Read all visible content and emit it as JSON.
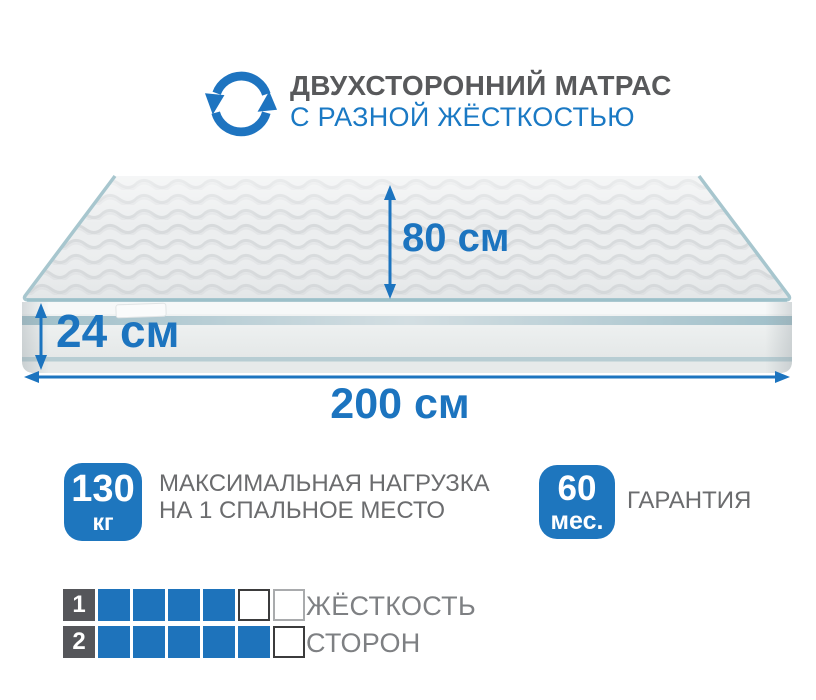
{
  "header": {
    "icon": "rotate-arrows-icon",
    "title": "ДВУХСТОРОННИЙ МАТРАС",
    "subtitle": "С РАЗНОЙ ЖЁСТКОСТЬЮ"
  },
  "dimensions": {
    "depth": "80 см",
    "thickness": "24 см",
    "length": "200 см"
  },
  "badges": [
    {
      "value": "130",
      "unit": "кг",
      "label_line1": "МАКСИМАЛЬНАЯ НАГРУЗКА",
      "label_line2": "НА 1 СПАЛЬНОЕ МЕСТО"
    },
    {
      "value": "60",
      "unit": "мес.",
      "label_line1": "ГАРАНТИЯ"
    }
  ],
  "firmness_scale": {
    "label_line1": "ЖЁСТКОСТЬ",
    "label_line2": "СТОРОН",
    "rows": [
      {
        "number": "1",
        "cells": [
          "filled",
          "filled",
          "filled",
          "filled",
          "empty-dark",
          "empty-light"
        ]
      },
      {
        "number": "2",
        "cells": [
          "filled",
          "filled",
          "filled",
          "filled",
          "filled",
          "empty-dark"
        ]
      }
    ]
  },
  "colors": {
    "accent_blue": "#1c74bf",
    "badge_blue": "#1e76be",
    "title_gray": "#58595b",
    "text_gray": "#6b6c6e",
    "scale_number_gray": "#55565a",
    "piping_teal": "#a7c6ce"
  }
}
